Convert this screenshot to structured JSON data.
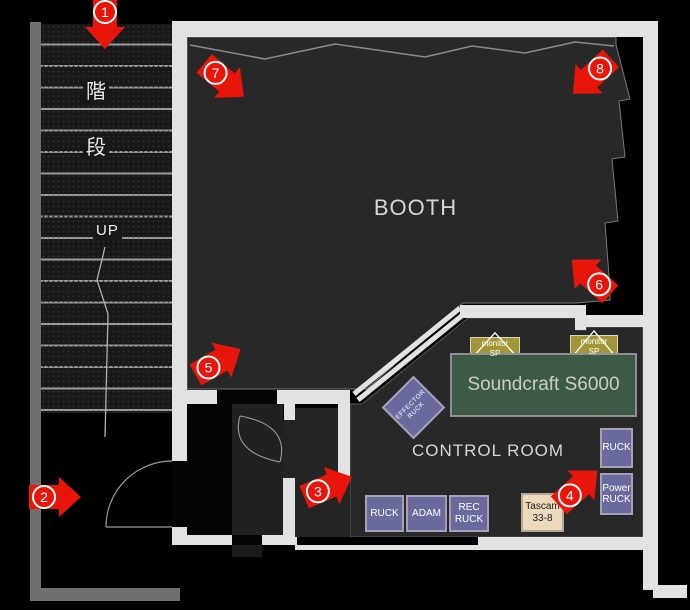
{
  "colors": {
    "arrow_red": "#e8160a",
    "wall_white": "#e2e2e2",
    "wall_gray": "#6f6f6f",
    "floor_dark": "#282828",
    "rack_purple": "#6a6a9e",
    "monitor_olive": "#a39638",
    "console_green": "#3d5a46",
    "tascam_beige": "#ecd9bd"
  },
  "stairs": {
    "kanji_top": "階",
    "kanji_bottom": "段",
    "up_label": "UP"
  },
  "rooms": {
    "booth": "BOOTH",
    "control_room": "CONTROL ROOM"
  },
  "equipment": {
    "monitor_sp_1": {
      "line1": "monitor",
      "line2": "SP"
    },
    "monitor_sp_2": {
      "line1": "monitor",
      "line2": "SP"
    },
    "console": {
      "label": "Soundcraft S6000"
    },
    "effector": {
      "line1": "EFFECTOR",
      "line2": "RUCK"
    },
    "ruck_side": {
      "label": "RUCK"
    },
    "power_ruck": {
      "line1": "Power",
      "line2": "RUCK"
    },
    "ruck_floor": {
      "label": "RUCK"
    },
    "adam": {
      "label": "ADAM"
    },
    "rec_ruck": {
      "line1": "REC",
      "line2": "RUCK"
    },
    "tascam": {
      "line1": "Tascam",
      "line2": "33-8"
    }
  },
  "markers": [
    {
      "n": "1"
    },
    {
      "n": "2"
    },
    {
      "n": "3"
    },
    {
      "n": "4"
    },
    {
      "n": "5"
    },
    {
      "n": "6"
    },
    {
      "n": "7"
    },
    {
      "n": "8"
    }
  ]
}
